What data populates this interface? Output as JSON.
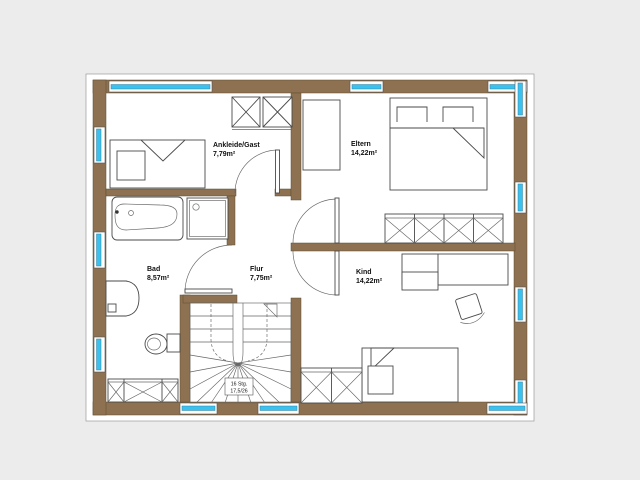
{
  "colors": {
    "background": "#ececec",
    "wall": "#8d7150",
    "glass": "#38c2f0",
    "line": "#4a4a4a",
    "text": "#111111"
  },
  "rooms": [
    {
      "id": "ankleide",
      "name": "Ankleide/Gast",
      "area": "7,79m²"
    },
    {
      "id": "eltern",
      "name": "Eltern",
      "area": "14,22m²"
    },
    {
      "id": "bad",
      "name": "Bad",
      "area": "8,57m²"
    },
    {
      "id": "flur",
      "name": "Flur",
      "area": "7,75m²"
    },
    {
      "id": "kind",
      "name": "Kind",
      "area": "14,22m²"
    }
  ],
  "stairs": {
    "label_line1": "16 Stg.",
    "label_line2": "17,5/26"
  }
}
